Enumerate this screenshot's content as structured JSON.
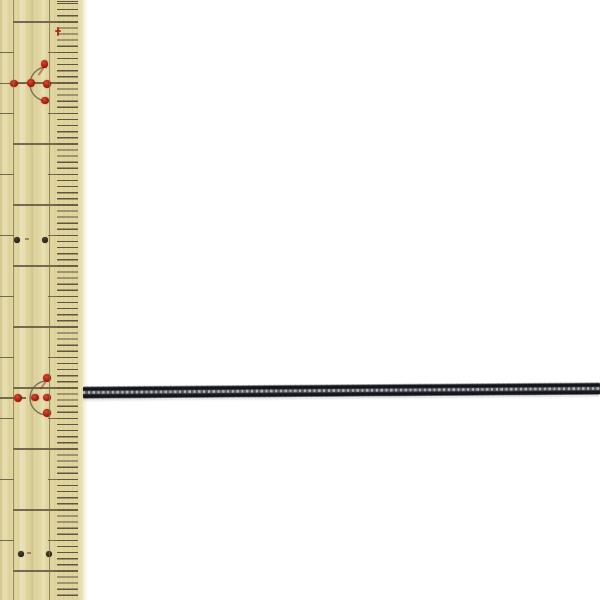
{
  "scene": {
    "subject": "thin black braided cord laid horizontally next to a vertical wooden ruler",
    "background_color": "#ffffff"
  },
  "ruler": {
    "width": 87,
    "wood_color": "#e1d69f",
    "tick_color": "rgba(70,64,50,0.9)",
    "line_color": "rgba(95,86,64,0.85)",
    "groove_color": "rgba(125,110,75,0.72)",
    "grooves_x": [
      12.5,
      48.5
    ],
    "row_start": 22,
    "row_spacing": 30.5,
    "row_count": 19,
    "mm_tick_spacing": 6.1,
    "zones": {
      "cm_line": [
        13,
        78
      ],
      "half_tick": [
        48,
        78
      ],
      "left_segment": [
        0,
        14
      ]
    },
    "marks": {
      "red_dot_color": "#a81d10",
      "black_dot_color": "#251f17",
      "arc_color": "rgba(107,96,82,0.85)",
      "red_plus": {
        "x": 58,
        "y": 31
      },
      "clusters": [
        {
          "arc_cx": 46.5,
          "arc_cy": 84,
          "r": 17,
          "line_y": 83.5,
          "line_x2": 24,
          "tail": [
            40,
            67
          ],
          "dots": [
            [
              44.5,
              64
            ],
            [
              14,
              83.5
            ],
            [
              31,
              83
            ],
            [
              47,
              84
            ],
            [
              45,
              100.5
            ]
          ]
        },
        {
          "arc_cx": 47,
          "arc_cy": 397.5,
          "r": 17,
          "line_y": 398,
          "line_x2": 26,
          "tail": [
            42,
            381
          ],
          "dots": [
            [
              47,
              378
            ],
            [
              18,
              398
            ],
            [
              35,
              397.5
            ],
            [
              47,
              397.5
            ],
            [
              47,
              413
            ]
          ]
        }
      ],
      "dot_pairs": [
        {
          "y": 240,
          "dots_x": [
            17,
            45
          ],
          "dash_x": 25
        },
        {
          "y": 554,
          "dots_x": [
            21,
            49
          ],
          "dash_x": 27
        }
      ]
    }
  },
  "cord": {
    "left": 83,
    "top": 386.3,
    "length": 517,
    "thickness": 13.4,
    "rotation_deg": -0.44,
    "dark_color": "#14161a",
    "core_color": "#8e9499"
  }
}
